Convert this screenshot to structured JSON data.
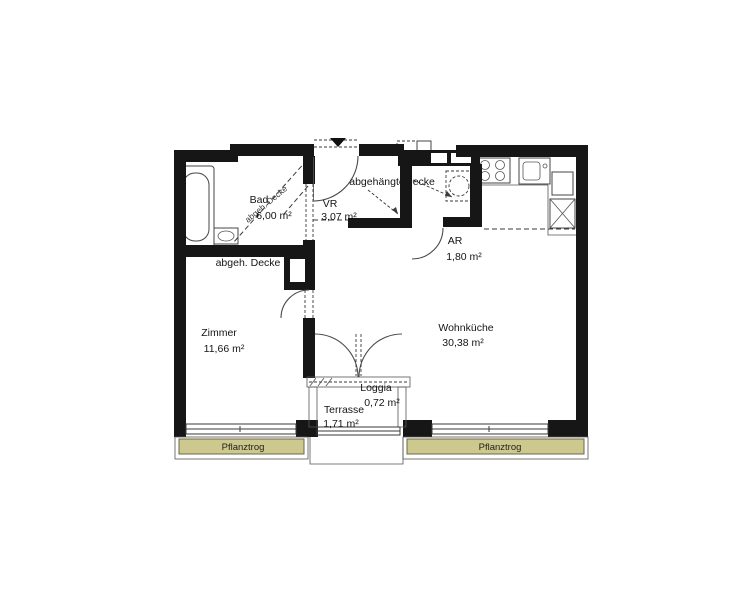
{
  "document": {
    "type": "floor-plan",
    "language": "de"
  },
  "rooms": [
    {
      "name": "Bad",
      "area": "6,00 m²"
    },
    {
      "name": "VR",
      "area": "3,07 m²"
    },
    {
      "name": "AR",
      "area": "1,80 m²"
    },
    {
      "name": "Zimmer",
      "area": "11,66 m²"
    },
    {
      "name": "Wohnküche",
      "area": "30,38 m²"
    },
    {
      "name": "Loggia",
      "area": "0,72 m²"
    },
    {
      "name": "Terrasse",
      "area": "1,71 m²"
    }
  ],
  "annotations": {
    "suspended_ceiling_part1": "abgehängte",
    "suspended_ceiling_part2": "Decke",
    "suspended_ceiling_abbr": "abgeh. Decke",
    "suspended_ceiling_bad": "abgeh. Decke",
    "planter_left": "Pflanztrog",
    "planter_right": "Pflanztrog"
  },
  "colors": {
    "wall": "#161616",
    "planter_fill": "#cdc88d",
    "planter_border": "#6b684a",
    "line": "#3a3a3a"
  }
}
